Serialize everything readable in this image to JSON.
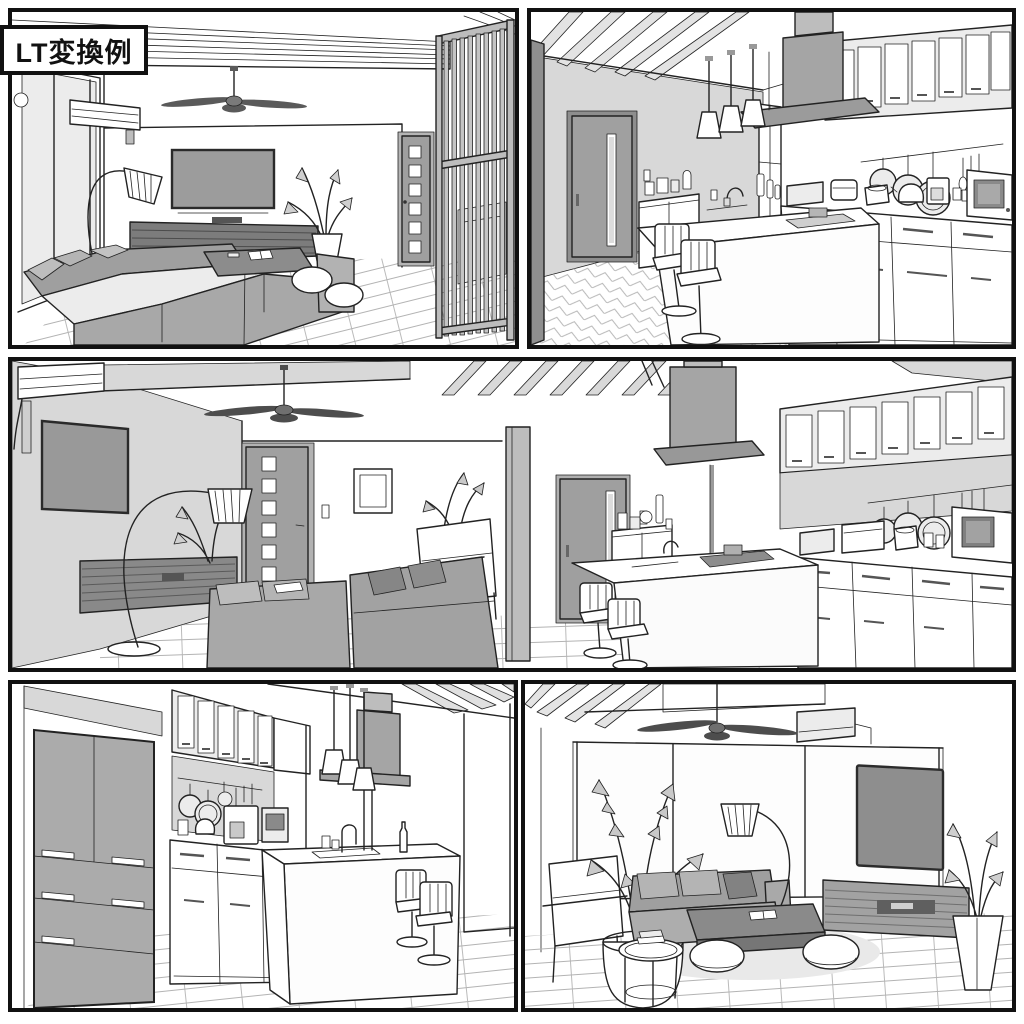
{
  "label": {
    "text": "LT変換例"
  },
  "palette": {
    "line": "#222222",
    "panel_border": "#111111",
    "wall_gray": "#d8d8d8",
    "furniture_gray": "#a5a5a5",
    "dark_gray": "#757575",
    "white": "#ffffff"
  },
  "panels": [
    {
      "id": "living-room-view-1",
      "description": "Living room: corner sofa, wall TV, arc floor lamp, ceiling fan, slatted TV board, door and vertical-slat partition"
    },
    {
      "id": "kitchen-view-1",
      "description": "Kitchen: island counter with bar stools, range hood, pendant lights, glass wall cabinets, hanging pans and counter appliances"
    },
    {
      "id": "ldk-wide-view",
      "description": "Wide LDK view: living area with TV wall, sofas, armchair and doors, kitchen with island, hood and cabinet run"
    },
    {
      "id": "kitchen-view-2",
      "description": "Kitchen reverse view: refrigerator, counter appliances, island sink, pendant lights and bar stools"
    },
    {
      "id": "living-room-view-2",
      "description": "Living room reverse view: plants, sofa, poufs, arc lamp, coffee table, wall TV and slatted low board"
    }
  ]
}
